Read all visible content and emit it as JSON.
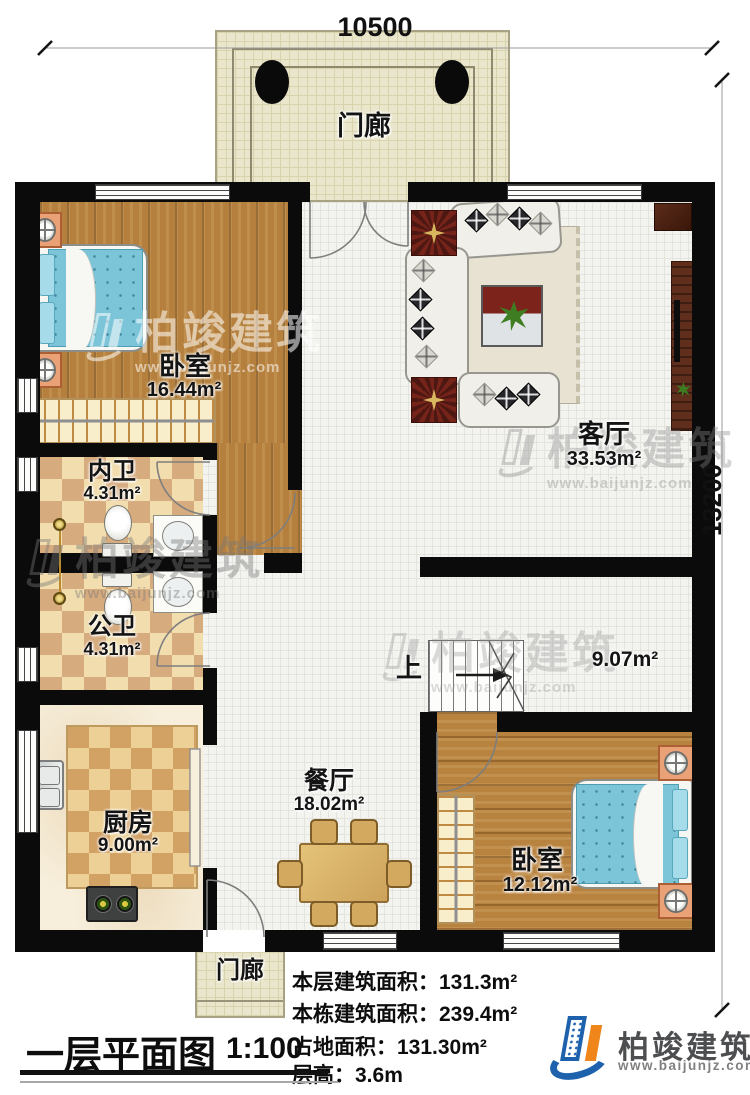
{
  "palette": {
    "wall": "#0b0b0b",
    "wood_floor": "#b5803d",
    "bath_tile_light": "#f0dcab",
    "bath_tile_dark": "#d6ab7e",
    "porch_tile": "#eae6cc",
    "hall_tile": "#f3f3f0",
    "bed_blue": "#7cc5d9",
    "dark_red_wood": "#76241a",
    "logo_blue": "#1e62ad",
    "logo_orange": "#f08519"
  },
  "dimensions": {
    "top": "10500",
    "right": "13200"
  },
  "rooms": {
    "porch_top": {
      "name": "门廊"
    },
    "bedroom1": {
      "name": "卧室",
      "area": "16.44m²"
    },
    "bath_inner": {
      "name": "内卫",
      "area": "4.31m²"
    },
    "bath_public": {
      "name": "公卫",
      "area": "4.31m²"
    },
    "kitchen": {
      "name": "厨房",
      "area": "9.00m²"
    },
    "dining": {
      "name": "餐厅",
      "area": "18.02m²"
    },
    "living": {
      "name": "客厅",
      "area": "33.53m²"
    },
    "stair": {
      "area": "9.07m²",
      "up": "上"
    },
    "bedroom2": {
      "name": "卧室",
      "area": "12.12m²"
    },
    "porch_bottom": {
      "name": "门廊"
    }
  },
  "info_lines": [
    "本层建筑面积：131.3m²",
    "本栋建筑面积：239.4m²",
    "占地面积：131.30m²",
    "层高：3.6m"
  ],
  "title_block": {
    "title": "一层平面图",
    "scale": "1:100"
  },
  "brand": {
    "company": "柏竣建筑",
    "website": "www.baijunjz.com"
  },
  "watermark": {
    "company": "柏竣建筑",
    "website": "www.baijunjz.com"
  }
}
